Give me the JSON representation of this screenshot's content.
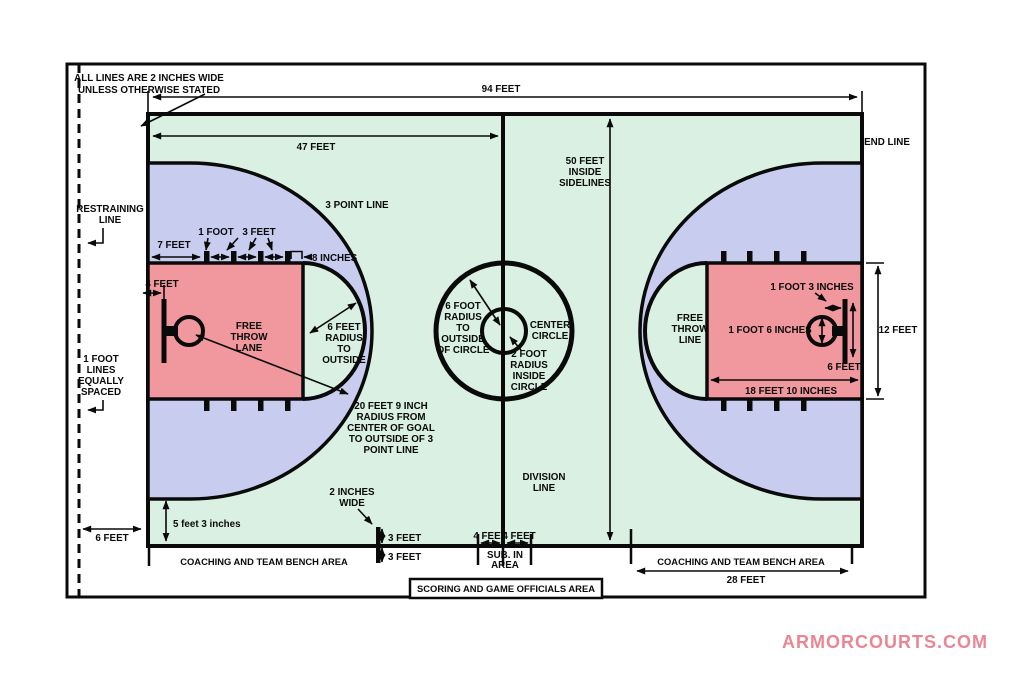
{
  "branding": {
    "website": "ARMORCOURTS.COM"
  },
  "colors": {
    "court_green": "#d9f0e2",
    "three_point_blue": "#c8cdef",
    "lane_pink": "#f0989e",
    "line": "#0a0a0a",
    "brand_pink": "#ea8593",
    "background": "#ffffff"
  },
  "labels": {
    "note": [
      "ALL LINES ARE 2 INCHES WIDE",
      "UNLESS OTHERWISE STATED"
    ],
    "court_length": "94 FEET",
    "half_court": "47 FEET",
    "end_line": "END LINE",
    "restraining_line": [
      "RESTRAINING",
      "LINE"
    ],
    "court_width": [
      "50 FEET",
      "INSIDE",
      "SIDELINES"
    ],
    "three_point_line": "3 POINT LINE",
    "seven_feet": "7 FEET",
    "one_foot": "1 FOOT",
    "three_feet": "3 FEET",
    "eight_inches": "8 INCHES",
    "four_feet": "4 FEET",
    "free_throw_lane": [
      "FREE",
      "THROW",
      "LANE"
    ],
    "six_feet_radius": [
      "6 FEET",
      "RADIUS",
      "TO",
      "OUTSIDE"
    ],
    "twenty_feet_nine": [
      "20 FEET 9 INCH",
      "RADIUS FROM",
      "CENTER OF GOAL",
      "TO OUTSIDE OF 3",
      "POINT LINE"
    ],
    "six_foot_radius": [
      "6 FOOT",
      "RADIUS",
      "TO",
      "OUTSIDE",
      "OF CIRCLE"
    ],
    "center_circle": [
      "CENTER",
      "CIRCLE"
    ],
    "two_foot_radius": [
      "2 FOOT",
      "RADIUS",
      "INSIDE",
      "CIRCLE"
    ],
    "division_line": [
      "DIVISION",
      "LINE"
    ],
    "one_foot_lines": [
      "1 FOOT",
      "LINES",
      "EQUALLY",
      "SPACED"
    ],
    "five_feet_three": "5 feet 3 inches",
    "six_feet": "6 FEET",
    "two_inches_wide": [
      "2 INCHES",
      "WIDE"
    ],
    "sub_in_area": [
      "SUB. IN",
      "AREA"
    ],
    "coaching_area": "COACHING AND TEAM BENCH AREA",
    "twenty_eight_feet": "28 FEET",
    "scoring_area": "SCORING AND GAME OFFICIALS AREA",
    "free_throw_line": [
      "FREE",
      "THROW",
      "LINE"
    ],
    "one_foot_three": "1 FOOT 3 INCHES",
    "one_foot_six": "1 FOOT 6 INCHES",
    "twelve_feet": "12 FEET",
    "eighteen_feet_ten": "18 FEET 10 INCHES"
  }
}
